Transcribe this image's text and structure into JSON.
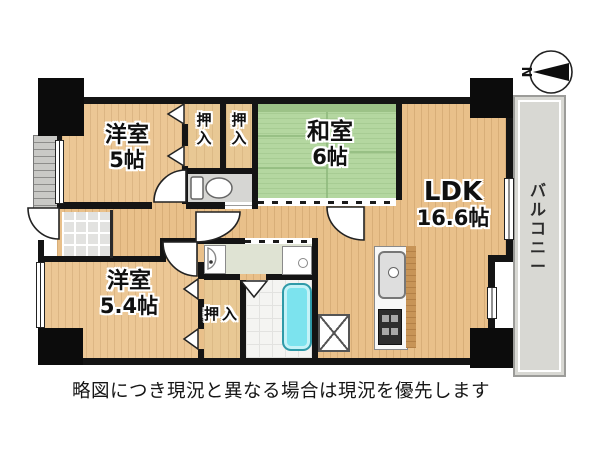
{
  "compass": {
    "label": "N"
  },
  "rooms": {
    "yoshitsu5": {
      "name": "洋室",
      "size": "5帖"
    },
    "washitsu6": {
      "name": "和室",
      "size": "6帖"
    },
    "ldk": {
      "name": "LDK",
      "size": "16.6帖"
    },
    "yoshitsu54": {
      "name": "洋室",
      "size": "5.4帖"
    },
    "balcony": {
      "name": "バルコニー"
    },
    "closet_top_1": {
      "name": "押入"
    },
    "closet_top_2": {
      "name": "押入"
    },
    "closet_bottom": {
      "name": "押入"
    }
  },
  "disclaimer": "略図につき現況と異なる場合は現況を優先します",
  "colors": {
    "wall": "#141414",
    "wood": "#e9c08a",
    "tatami": "#b4d7a0",
    "balcony": "#d8d8d3",
    "bath_tub": "#7ce3ee"
  }
}
